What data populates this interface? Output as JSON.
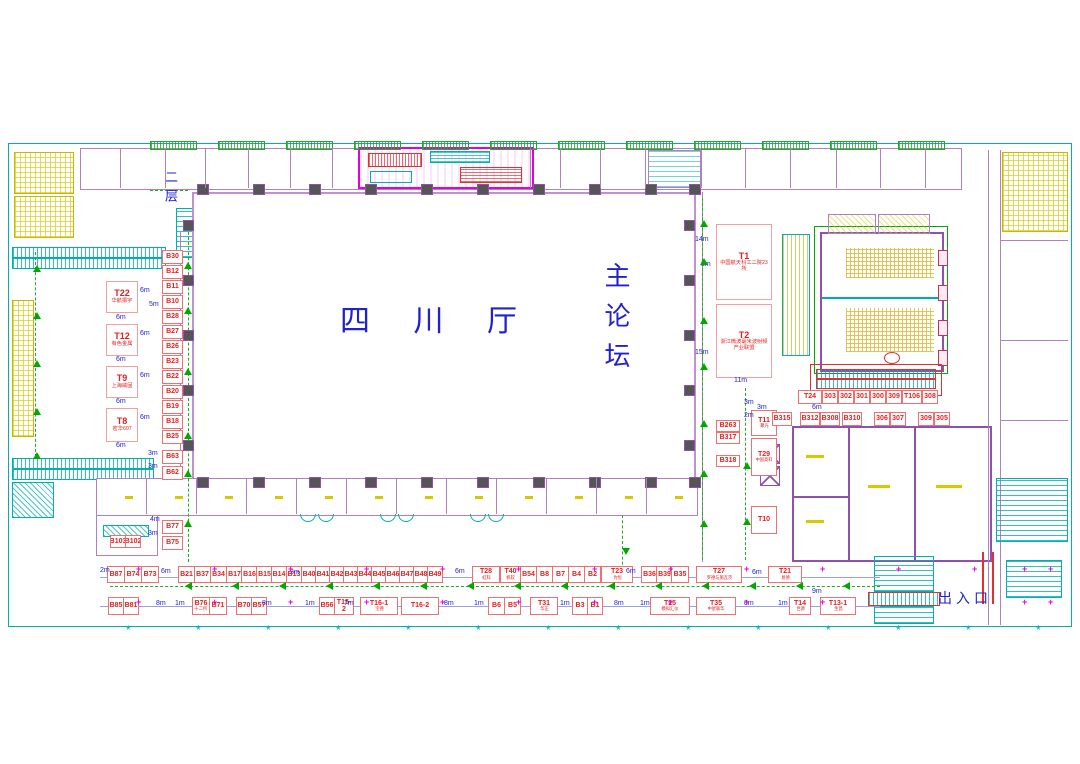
{
  "texts": {
    "hall_name": "四 川 厅",
    "forum_vertical": "主论坛",
    "floor_vertical": "二层",
    "entrance": "出入口"
  },
  "colors": {
    "teal": "#00b0b0",
    "wall_purple": "#9050b0",
    "magenta": "#e000e0",
    "green": "#00a800",
    "booth_red": "#e02020",
    "dim_blue": "#2222cc",
    "yellow": "#d8c800"
  },
  "booths": [
    {
      "id": "T22",
      "name": "华航振宇",
      "x": 106,
      "y": 281,
      "w": 30,
      "h": 30,
      "cls": "big"
    },
    {
      "id": "T12",
      "name": "有色金属",
      "x": 106,
      "y": 324,
      "w": 30,
      "h": 30,
      "cls": "big"
    },
    {
      "id": "T9",
      "name": "上海威固",
      "x": 106,
      "y": 366,
      "w": 30,
      "h": 30,
      "cls": "big"
    },
    {
      "id": "T8",
      "name": "密华607",
      "x": 106,
      "y": 408,
      "w": 30,
      "h": 32,
      "cls": "big"
    },
    {
      "id": "B30",
      "x": 162,
      "y": 250,
      "w": 19,
      "h": 12
    },
    {
      "id": "B12",
      "x": 162,
      "y": 265,
      "w": 19,
      "h": 12
    },
    {
      "id": "B11",
      "x": 162,
      "y": 280,
      "w": 19,
      "h": 12
    },
    {
      "id": "B10",
      "x": 162,
      "y": 295,
      "w": 19,
      "h": 12
    },
    {
      "id": "B28",
      "x": 162,
      "y": 310,
      "w": 19,
      "h": 12
    },
    {
      "id": "B27",
      "x": 162,
      "y": 325,
      "w": 19,
      "h": 12
    },
    {
      "id": "B26",
      "x": 162,
      "y": 340,
      "w": 19,
      "h": 12
    },
    {
      "id": "B23",
      "x": 162,
      "y": 355,
      "w": 19,
      "h": 12
    },
    {
      "id": "B22",
      "x": 162,
      "y": 370,
      "w": 19,
      "h": 12
    },
    {
      "id": "B20",
      "x": 162,
      "y": 385,
      "w": 19,
      "h": 12
    },
    {
      "id": "B19",
      "x": 162,
      "y": 400,
      "w": 19,
      "h": 12
    },
    {
      "id": "B18",
      "x": 162,
      "y": 415,
      "w": 19,
      "h": 12
    },
    {
      "id": "B25",
      "x": 162,
      "y": 430,
      "w": 19,
      "h": 12
    },
    {
      "id": "B63",
      "x": 162,
      "y": 450,
      "w": 19,
      "h": 12
    },
    {
      "id": "B62",
      "x": 162,
      "y": 466,
      "w": 19,
      "h": 12
    },
    {
      "id": "B77",
      "x": 162,
      "y": 520,
      "w": 19,
      "h": 12
    },
    {
      "id": "B75",
      "x": 162,
      "y": 536,
      "w": 19,
      "h": 12
    },
    {
      "id": "B103",
      "x": 110,
      "y": 535,
      "w": 14,
      "h": 11
    },
    {
      "id": "B102",
      "x": 125,
      "y": 535,
      "w": 14,
      "h": 11
    },
    {
      "id": "T1",
      "name": "中国航天科工二院23所",
      "x": 716,
      "y": 224,
      "w": 54,
      "h": 74,
      "cls": "big"
    },
    {
      "id": "T2",
      "name": "浙江微波毫米波射频产业联盟",
      "x": 716,
      "y": 304,
      "w": 54,
      "h": 72,
      "cls": "big"
    },
    {
      "id": "T11",
      "name": "聚光",
      "x": 751,
      "y": 410,
      "w": 24,
      "h": 24
    },
    {
      "id": "T29",
      "name": "中国高科",
      "x": 751,
      "y": 438,
      "w": 24,
      "h": 36
    },
    {
      "id": "T10",
      "x": 751,
      "y": 506,
      "w": 24,
      "h": 26
    },
    {
      "id": "B263",
      "x": 716,
      "y": 420,
      "w": 22,
      "h": 10
    },
    {
      "id": "B317",
      "x": 716,
      "y": 432,
      "w": 22,
      "h": 10
    },
    {
      "id": "B318",
      "x": 716,
      "y": 455,
      "w": 22,
      "h": 10
    },
    {
      "id": "B315",
      "x": 772,
      "y": 412,
      "w": 18,
      "h": 12
    },
    {
      "id": "T24",
      "x": 798,
      "y": 390,
      "w": 22,
      "h": 12
    },
    {
      "id": "303",
      "x": 822,
      "y": 390,
      "w": 14,
      "h": 12
    },
    {
      "id": "302",
      "x": 838,
      "y": 390,
      "w": 14,
      "h": 12
    },
    {
      "id": "301",
      "x": 854,
      "y": 390,
      "w": 14,
      "h": 12
    },
    {
      "id": "300",
      "x": 870,
      "y": 390,
      "w": 14,
      "h": 12
    },
    {
      "id": "309",
      "x": 886,
      "y": 390,
      "w": 14,
      "h": 12
    },
    {
      "id": "T106",
      "x": 902,
      "y": 390,
      "w": 18,
      "h": 12
    },
    {
      "id": "308",
      "x": 922,
      "y": 390,
      "w": 14,
      "h": 12
    },
    {
      "id": "B312",
      "x": 800,
      "y": 412,
      "w": 18,
      "h": 12
    },
    {
      "id": "B308",
      "x": 820,
      "y": 412,
      "w": 18,
      "h": 12
    },
    {
      "id": "B310",
      "x": 842,
      "y": 412,
      "w": 18,
      "h": 12
    },
    {
      "id": "306",
      "x": 874,
      "y": 412,
      "w": 14,
      "h": 12
    },
    {
      "id": "307",
      "x": 890,
      "y": 412,
      "w": 14,
      "h": 12
    },
    {
      "id": "309",
      "x": 918,
      "y": 412,
      "w": 14,
      "h": 12
    },
    {
      "id": "305",
      "x": 934,
      "y": 412,
      "w": 14,
      "h": 12
    },
    {
      "id": "B87",
      "x": 107,
      "y": 566,
      "w": 16,
      "h": 15
    },
    {
      "id": "B74",
      "x": 124,
      "y": 566,
      "w": 16,
      "h": 15
    },
    {
      "id": "B73",
      "x": 141,
      "y": 566,
      "w": 16,
      "h": 15
    },
    {
      "id": "B21",
      "x": 178,
      "y": 566,
      "w": 15,
      "h": 15
    },
    {
      "id": "B37",
      "x": 194,
      "y": 566,
      "w": 15,
      "h": 15
    },
    {
      "id": "B34",
      "x": 210,
      "y": 566,
      "w": 15,
      "h": 15
    },
    {
      "id": "B17",
      "x": 226,
      "y": 566,
      "w": 15,
      "h": 15
    },
    {
      "id": "B16",
      "x": 241,
      "y": 566,
      "w": 15,
      "h": 15
    },
    {
      "id": "B15",
      "x": 256,
      "y": 566,
      "w": 15,
      "h": 15
    },
    {
      "id": "B14",
      "x": 271,
      "y": 566,
      "w": 14,
      "h": 15
    },
    {
      "id": "B13",
      "x": 286,
      "y": 566,
      "w": 14,
      "h": 15
    },
    {
      "id": "B40",
      "x": 301,
      "y": 566,
      "w": 14,
      "h": 15
    },
    {
      "id": "B41",
      "x": 315,
      "y": 566,
      "w": 14,
      "h": 15
    },
    {
      "id": "B42",
      "x": 329,
      "y": 566,
      "w": 14,
      "h": 15
    },
    {
      "id": "B43",
      "x": 343,
      "y": 566,
      "w": 14,
      "h": 15
    },
    {
      "id": "B44",
      "x": 357,
      "y": 566,
      "w": 14,
      "h": 15
    },
    {
      "id": "B45",
      "x": 371,
      "y": 566,
      "w": 14,
      "h": 15
    },
    {
      "id": "B46",
      "x": 385,
      "y": 566,
      "w": 14,
      "h": 15
    },
    {
      "id": "B47",
      "x": 399,
      "y": 566,
      "w": 14,
      "h": 15
    },
    {
      "id": "B48",
      "x": 413,
      "y": 566,
      "w": 14,
      "h": 15
    },
    {
      "id": "B49",
      "x": 427,
      "y": 566,
      "w": 14,
      "h": 15
    },
    {
      "id": "T28",
      "name": "虹科",
      "x": 472,
      "y": 566,
      "w": 26,
      "h": 15
    },
    {
      "id": "T40",
      "name": "帆软",
      "x": 500,
      "y": 566,
      "w": 19,
      "h": 15
    },
    {
      "id": "B54",
      "x": 520,
      "y": 566,
      "w": 15,
      "h": 15
    },
    {
      "id": "B8",
      "x": 536,
      "y": 566,
      "w": 15,
      "h": 15
    },
    {
      "id": "B7",
      "x": 552,
      "y": 566,
      "w": 15,
      "h": 15
    },
    {
      "id": "B4",
      "x": 568,
      "y": 566,
      "w": 15,
      "h": 15
    },
    {
      "id": "B2",
      "x": 584,
      "y": 566,
      "w": 15,
      "h": 15
    },
    {
      "id": "T23",
      "name": "为恒",
      "x": 601,
      "y": 566,
      "w": 30,
      "h": 15
    },
    {
      "id": "B36",
      "x": 641,
      "y": 566,
      "w": 15,
      "h": 15
    },
    {
      "id": "B39",
      "x": 656,
      "y": 566,
      "w": 15,
      "h": 15
    },
    {
      "id": "B35",
      "x": 671,
      "y": 566,
      "w": 16,
      "h": 15
    },
    {
      "id": "T27",
      "name": "罗德与施瓦茨",
      "x": 696,
      "y": 566,
      "w": 44,
      "h": 15
    },
    {
      "id": "T21",
      "name": "易德",
      "x": 768,
      "y": 566,
      "w": 32,
      "h": 15
    },
    {
      "id": "B85",
      "x": 108,
      "y": 597,
      "w": 14,
      "h": 16
    },
    {
      "id": "B81",
      "x": 123,
      "y": 597,
      "w": 14,
      "h": 16
    },
    {
      "id": "B76",
      "name": "十二所",
      "x": 192,
      "y": 597,
      "w": 16,
      "h": 16
    },
    {
      "id": "B71",
      "x": 209,
      "y": 597,
      "w": 16,
      "h": 16
    },
    {
      "id": "B70",
      "x": 236,
      "y": 597,
      "w": 14,
      "h": 16
    },
    {
      "id": "B57",
      "x": 251,
      "y": 597,
      "w": 14,
      "h": 16
    },
    {
      "id": "B56",
      "x": 319,
      "y": 597,
      "w": 14,
      "h": 16
    },
    {
      "id": "T15-2",
      "x": 334,
      "y": 597,
      "w": 18,
      "h": 16
    },
    {
      "id": "T16-1",
      "name": "宝德",
      "x": 360,
      "y": 597,
      "w": 36,
      "h": 16
    },
    {
      "id": "T16-2",
      "x": 401,
      "y": 597,
      "w": 36,
      "h": 16
    },
    {
      "id": "B6",
      "x": 488,
      "y": 597,
      "w": 15,
      "h": 16
    },
    {
      "id": "B5",
      "x": 504,
      "y": 597,
      "w": 15,
      "h": 16
    },
    {
      "id": "T31",
      "name": "华正",
      "x": 530,
      "y": 597,
      "w": 26,
      "h": 16
    },
    {
      "id": "B3",
      "x": 572,
      "y": 597,
      "w": 14,
      "h": 16
    },
    {
      "id": "B1",
      "x": 587,
      "y": 597,
      "w": 14,
      "h": 16
    },
    {
      "id": "T25",
      "name": "模拟汇仪",
      "x": 650,
      "y": 597,
      "w": 38,
      "h": 16
    },
    {
      "id": "T35",
      "name": "中星联华",
      "x": 696,
      "y": 597,
      "w": 38,
      "h": 16
    },
    {
      "id": "T14",
      "name": "世源",
      "x": 789,
      "y": 597,
      "w": 20,
      "h": 16
    },
    {
      "id": "T13-1",
      "name": "生昌",
      "x": 820,
      "y": 597,
      "w": 34,
      "h": 16
    }
  ],
  "dims": [
    {
      "t": "2m",
      "x": 100,
      "y": 567
    },
    {
      "t": "6m",
      "x": 161,
      "y": 568
    },
    {
      "t": "3m",
      "x": 290,
      "y": 569
    },
    {
      "t": "6m",
      "x": 455,
      "y": 568
    },
    {
      "t": "6m",
      "x": 626,
      "y": 568
    },
    {
      "t": "6m",
      "x": 752,
      "y": 569
    },
    {
      "t": "8m",
      "x": 156,
      "y": 600
    },
    {
      "t": "1m",
      "x": 175,
      "y": 600
    },
    {
      "t": "8m",
      "x": 262,
      "y": 600
    },
    {
      "t": "1m",
      "x": 305,
      "y": 600
    },
    {
      "t": "7m",
      "x": 344,
      "y": 600
    },
    {
      "t": "8m",
      "x": 444,
      "y": 600
    },
    {
      "t": "1m",
      "x": 474,
      "y": 600
    },
    {
      "t": "1m",
      "x": 560,
      "y": 600
    },
    {
      "t": "8m",
      "x": 614,
      "y": 600
    },
    {
      "t": "1m",
      "x": 640,
      "y": 600
    },
    {
      "t": "8m",
      "x": 744,
      "y": 600
    },
    {
      "t": "1m",
      "x": 778,
      "y": 600
    },
    {
      "t": "9m",
      "x": 812,
      "y": 588
    },
    {
      "t": "6m",
      "x": 140,
      "y": 287
    },
    {
      "t": "6m",
      "x": 116,
      "y": 314
    },
    {
      "t": "5m",
      "x": 149,
      "y": 301
    },
    {
      "t": "6m",
      "x": 140,
      "y": 330
    },
    {
      "t": "6m",
      "x": 116,
      "y": 356
    },
    {
      "t": "6m",
      "x": 140,
      "y": 372
    },
    {
      "t": "6m",
      "x": 116,
      "y": 398
    },
    {
      "t": "6m",
      "x": 140,
      "y": 414
    },
    {
      "t": "6m",
      "x": 116,
      "y": 442
    },
    {
      "t": "3m",
      "x": 148,
      "y": 450
    },
    {
      "t": "3m",
      "x": 148,
      "y": 463
    },
    {
      "t": "4m",
      "x": 150,
      "y": 516
    },
    {
      "t": "3m",
      "x": 148,
      "y": 530
    },
    {
      "t": "14m",
      "x": 695,
      "y": 236
    },
    {
      "t": "3m",
      "x": 701,
      "y": 261
    },
    {
      "t": "15m",
      "x": 695,
      "y": 349
    },
    {
      "t": "11m",
      "x": 734,
      "y": 377
    },
    {
      "t": "3m",
      "x": 744,
      "y": 399
    },
    {
      "t": "2m",
      "x": 744,
      "y": 412
    },
    {
      "t": "3m",
      "x": 757,
      "y": 404
    },
    {
      "t": "6m",
      "x": 812,
      "y": 404
    }
  ],
  "arrows": [
    {
      "d": "up",
      "x": 184,
      "y": 262
    },
    {
      "d": "up",
      "x": 184,
      "y": 307
    },
    {
      "d": "up",
      "x": 184,
      "y": 368
    },
    {
      "d": "up",
      "x": 184,
      "y": 432
    },
    {
      "d": "up",
      "x": 184,
      "y": 470
    },
    {
      "d": "up",
      "x": 184,
      "y": 520
    },
    {
      "d": "up",
      "x": 33,
      "y": 265
    },
    {
      "d": "up",
      "x": 33,
      "y": 312
    },
    {
      "d": "up",
      "x": 33,
      "y": 360
    },
    {
      "d": "up",
      "x": 33,
      "y": 408
    },
    {
      "d": "up",
      "x": 33,
      "y": 452
    },
    {
      "d": "up",
      "x": 700,
      "y": 220
    },
    {
      "d": "up",
      "x": 700,
      "y": 258
    },
    {
      "d": "up",
      "x": 700,
      "y": 317
    },
    {
      "d": "up",
      "x": 700,
      "y": 363
    },
    {
      "d": "up",
      "x": 700,
      "y": 420
    },
    {
      "d": "up",
      "x": 700,
      "y": 470
    },
    {
      "d": "up",
      "x": 700,
      "y": 520
    },
    {
      "d": "up",
      "x": 743,
      "y": 462
    },
    {
      "d": "up",
      "x": 743,
      "y": 518
    },
    {
      "d": "left",
      "x": 185,
      "y": 582
    },
    {
      "d": "left",
      "x": 232,
      "y": 582
    },
    {
      "d": "left",
      "x": 279,
      "y": 582
    },
    {
      "d": "left",
      "x": 326,
      "y": 582
    },
    {
      "d": "left",
      "x": 373,
      "y": 582
    },
    {
      "d": "left",
      "x": 420,
      "y": 582
    },
    {
      "d": "left",
      "x": 467,
      "y": 582
    },
    {
      "d": "left",
      "x": 514,
      "y": 582
    },
    {
      "d": "left",
      "x": 561,
      "y": 582
    },
    {
      "d": "left",
      "x": 608,
      "y": 582
    },
    {
      "d": "left",
      "x": 655,
      "y": 582
    },
    {
      "d": "left",
      "x": 702,
      "y": 582
    },
    {
      "d": "left",
      "x": 749,
      "y": 582
    },
    {
      "d": "left",
      "x": 796,
      "y": 582
    },
    {
      "d": "left",
      "x": 843,
      "y": 582
    },
    {
      "d": "down",
      "x": 622,
      "y": 548
    }
  ],
  "markers": {
    "plus": [
      {
        "x": 136,
        "y": 565
      },
      {
        "x": 212,
        "y": 565
      },
      {
        "x": 288,
        "y": 565
      },
      {
        "x": 364,
        "y": 565
      },
      {
        "x": 440,
        "y": 565
      },
      {
        "x": 516,
        "y": 565
      },
      {
        "x": 592,
        "y": 565
      },
      {
        "x": 668,
        "y": 565
      },
      {
        "x": 744,
        "y": 565
      },
      {
        "x": 820,
        "y": 565
      },
      {
        "x": 896,
        "y": 565
      },
      {
        "x": 972,
        "y": 565
      },
      {
        "x": 1022,
        "y": 565
      },
      {
        "x": 1048,
        "y": 565
      },
      {
        "x": 136,
        "y": 598
      },
      {
        "x": 212,
        "y": 598
      },
      {
        "x": 288,
        "y": 598
      },
      {
        "x": 364,
        "y": 598
      },
      {
        "x": 440,
        "y": 598
      },
      {
        "x": 516,
        "y": 598
      },
      {
        "x": 592,
        "y": 598
      },
      {
        "x": 668,
        "y": 598
      },
      {
        "x": 744,
        "y": 598
      },
      {
        "x": 820,
        "y": 598
      },
      {
        "x": 1022,
        "y": 598
      },
      {
        "x": 1048,
        "y": 598
      }
    ],
    "flowers": [
      {
        "x": 126,
        "y": 624
      },
      {
        "x": 196,
        "y": 624
      },
      {
        "x": 266,
        "y": 624
      },
      {
        "x": 336,
        "y": 624
      },
      {
        "x": 406,
        "y": 624
      },
      {
        "x": 476,
        "y": 624
      },
      {
        "x": 546,
        "y": 624
      },
      {
        "x": 616,
        "y": 624
      },
      {
        "x": 686,
        "y": 624
      },
      {
        "x": 756,
        "y": 624
      },
      {
        "x": 826,
        "y": 624
      },
      {
        "x": 896,
        "y": 624
      },
      {
        "x": 966,
        "y": 624
      },
      {
        "x": 1036,
        "y": 624
      }
    ]
  }
}
